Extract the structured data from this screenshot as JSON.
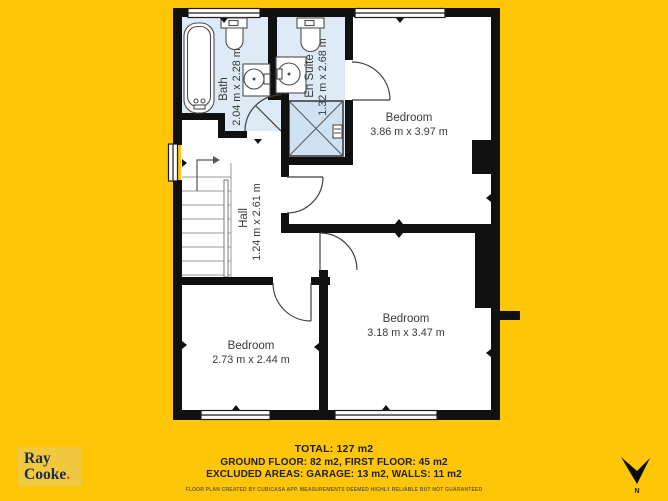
{
  "title": "First floor plan",
  "colors": {
    "background": "#FEC609",
    "room_fill": "#DEEAF6",
    "shower_fill": "#CFE2F2",
    "wall": "#101010",
    "label": "#3A3A3A",
    "logo_bg": "#F1C93E",
    "logo_text": "#1D2B4D",
    "logo_dot": "#E2482C"
  },
  "rooms": [
    {
      "name": "Bath",
      "dims": "2.04 m x 2.28 m"
    },
    {
      "name": "En Suite",
      "dims": "1.32 m x 2.68 m"
    },
    {
      "name": "Hall",
      "dims": "1.24 m x 2.61 m"
    },
    {
      "name": "Bedroom",
      "dims": "3.86 m x 3.97 m"
    },
    {
      "name": "Bedroom",
      "dims": "3.18 m x 3.47 m"
    },
    {
      "name": "Bedroom",
      "dims": "2.73 m x 2.44 m"
    }
  ],
  "footer": {
    "total": "TOTAL: 127 m2",
    "floors": "GROUND FLOOR: 82 m2, FIRST FLOOR: 45 m2",
    "excluded": "EXCLUDED AREAS: GARAGE: 13 m2, WALLS: 11 m2",
    "disclaimer": "FLOOR PLAN CREATED BY CUBICASA APP. MEASUREMENTS DEEMED HIGHLY RELIABLE BUT NOT GUARANTEED"
  },
  "branding": {
    "line1": "Ray",
    "line2": "Cooke",
    "dot": "."
  },
  "compass": {
    "label": "N"
  }
}
